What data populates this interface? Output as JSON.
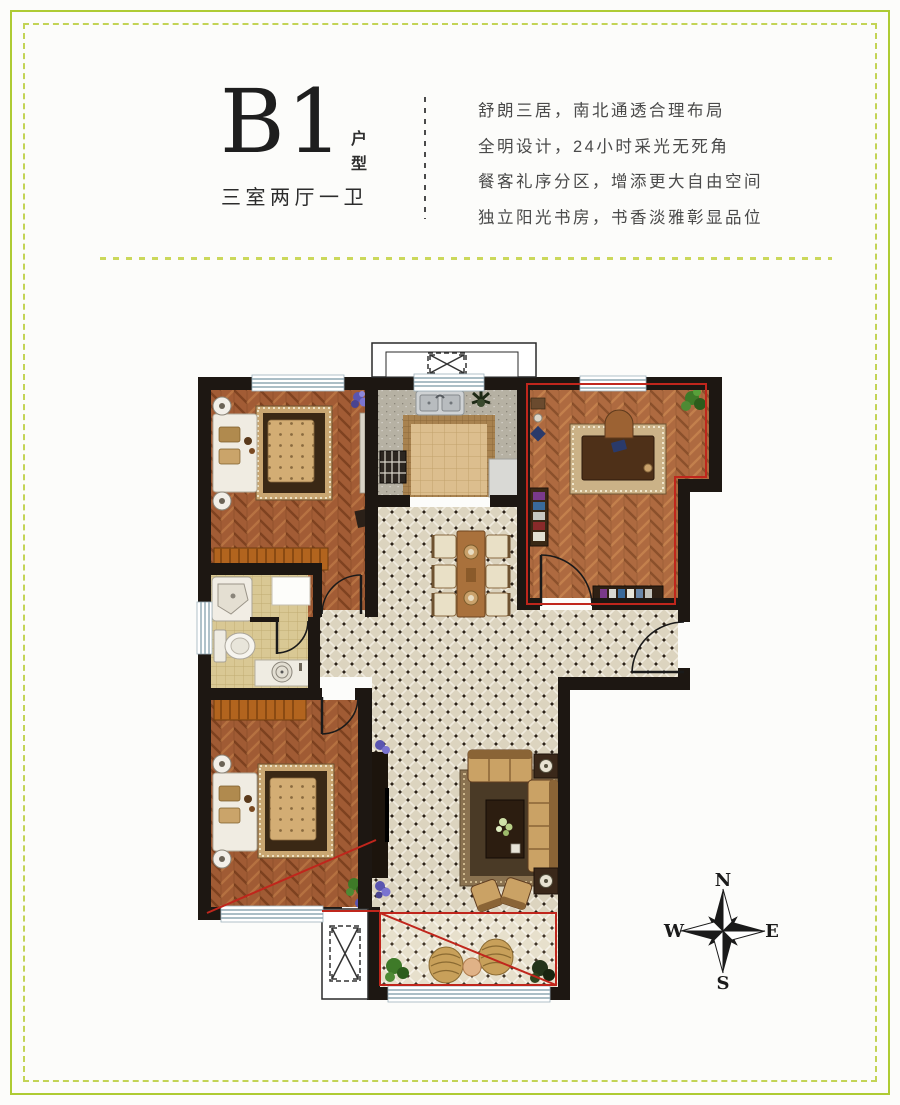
{
  "header": {
    "unit_code": "B1",
    "unit_type_vertical": "户型",
    "layout_summary": "三室两厅一卫",
    "description_lines": [
      "舒朗三居，南北通透合理布局",
      "全明设计，24小时采光无死角",
      "餐客礼序分区，增添更大自由空间",
      "独立阳光书房，书香淡雅彰显品位"
    ]
  },
  "compass": {
    "north": "N",
    "south": "S",
    "east": "E",
    "west": "W"
  },
  "colors": {
    "page_border_green": "#b5cf3e",
    "highlight_red": "#c0261c",
    "wall_dark": "#1d1712",
    "wood_floor": "#a5613a",
    "tile_floor": "#dcd4bf",
    "window_blue": "#8fa8b4"
  }
}
